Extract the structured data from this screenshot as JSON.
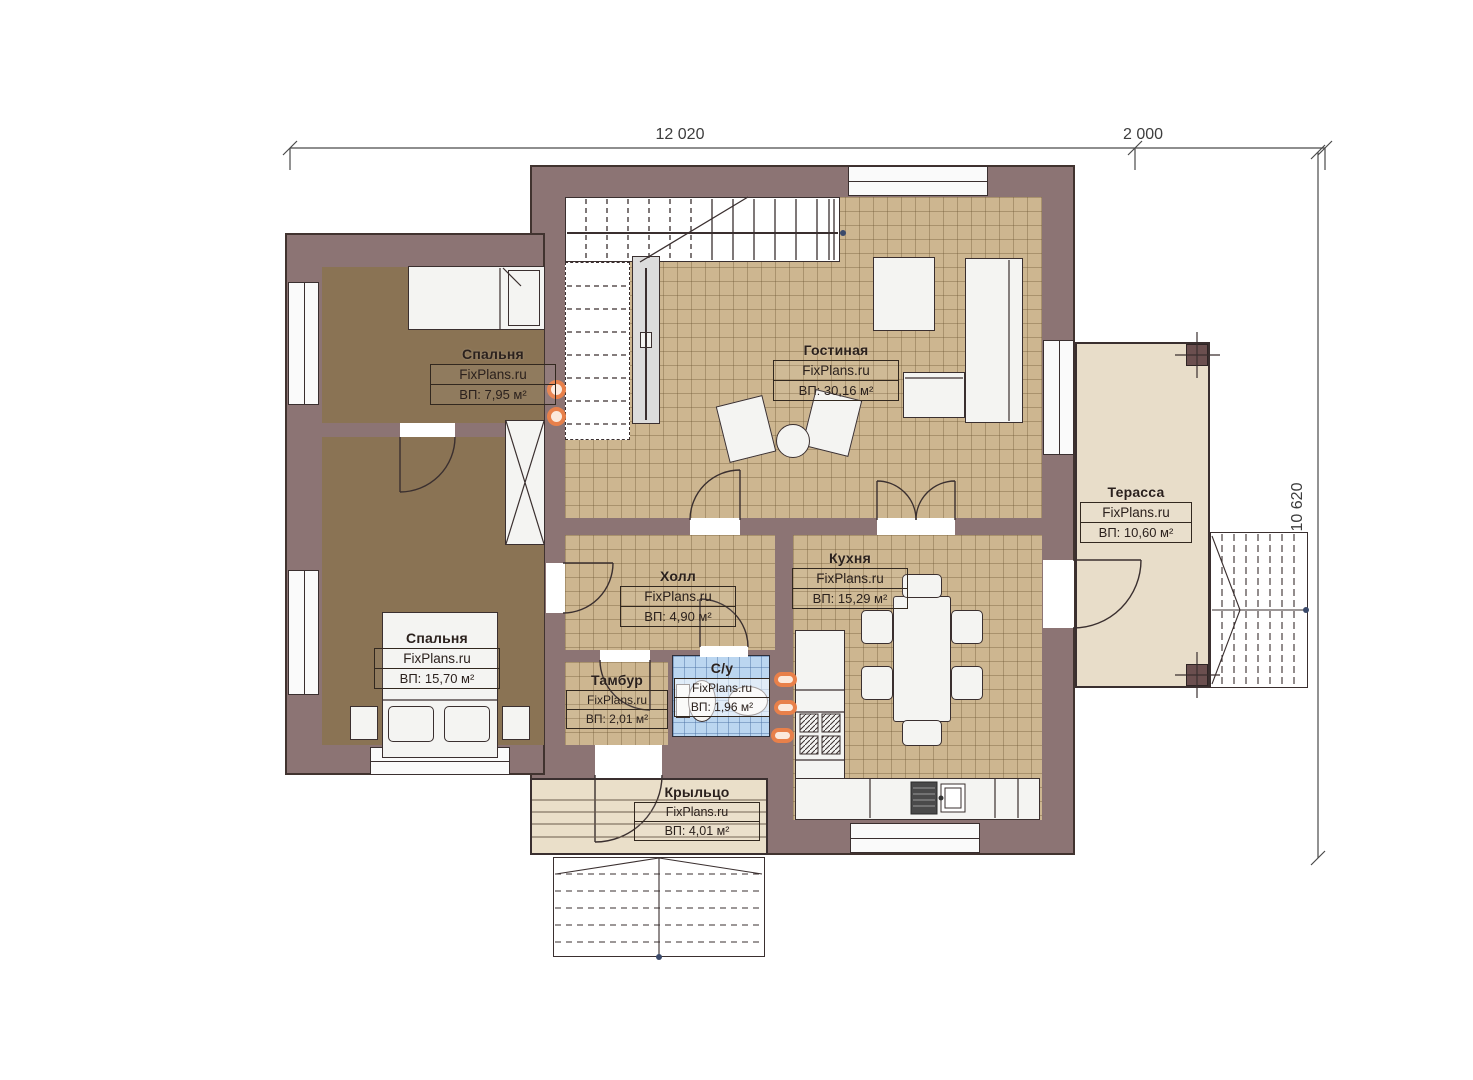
{
  "plan": {
    "title": "floor-plan",
    "dimensions": {
      "top_main": "12 020",
      "top_right": "2 000",
      "right_side": "10 620"
    },
    "rooms": [
      {
        "id": "bedroom-1",
        "name": "Спальня",
        "brand": "FixPlans.ru",
        "area": "ВП: 7,95 м²"
      },
      {
        "id": "bedroom-2",
        "name": "Спальня",
        "brand": "FixPlans.ru",
        "area": "ВП: 15,70 м²"
      },
      {
        "id": "living",
        "name": "Гостиная",
        "brand": "FixPlans.ru",
        "area": "ВП: 30,16 м²"
      },
      {
        "id": "hall",
        "name": "Холл",
        "brand": "FixPlans.ru",
        "area": "ВП: 4,90 м²"
      },
      {
        "id": "kitchen",
        "name": "Кухня",
        "brand": "FixPlans.ru",
        "area": "ВП: 15,29 м²"
      },
      {
        "id": "tambour",
        "name": "Тамбур",
        "brand": "FixPlans.ru",
        "area": "ВП: 2,01 м²"
      },
      {
        "id": "wc",
        "name": "С/у",
        "brand": "FixPlans.ru",
        "area": "ВП: 1,96 м²"
      },
      {
        "id": "terrace",
        "name": "Терасса",
        "brand": "FixPlans.ru",
        "area": "ВП: 10,60 м²"
      },
      {
        "id": "porch",
        "name": "Крыльцо",
        "brand": "FixPlans.ru",
        "area": "ВП: 4,01 м²"
      }
    ],
    "colors": {
      "wall": "#8C7474",
      "wall_outline": "#41332F",
      "bedroom_floor": "#8A7354",
      "tile_floor": "#CDB690",
      "wet_floor": "#BBD6F0",
      "terrace_floor": "#E8DDC9",
      "accent_orange": "#E8804A"
    }
  }
}
